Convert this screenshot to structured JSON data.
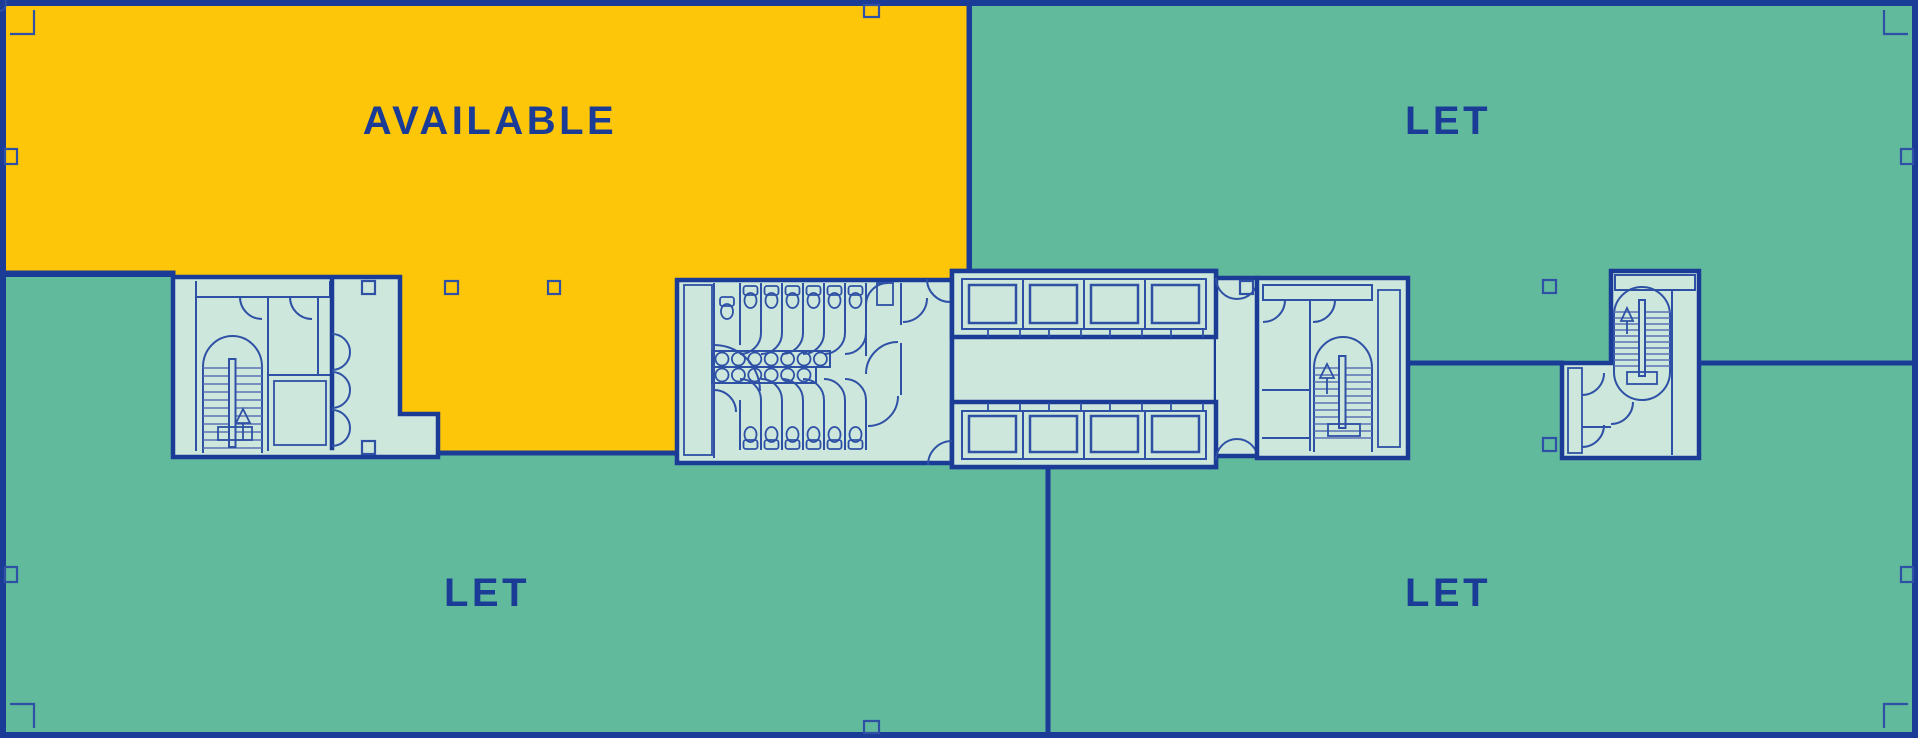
{
  "page": {
    "type": "interactive-letting-floorplan"
  },
  "units": [
    {
      "id": "available",
      "label": "AVAILABLE",
      "status": "available"
    },
    {
      "id": "let-top-right",
      "label": "LET",
      "status": "let"
    },
    {
      "id": "let-bottom-left",
      "label": "LET",
      "status": "let"
    },
    {
      "id": "let-bottom-right",
      "label": "LET",
      "status": "let"
    }
  ],
  "colors": {
    "available": "#FDC608",
    "let": "#62BA9D",
    "core": "#CEE7DC",
    "lift_car": "#97D1BB",
    "ink": "#1B3C96",
    "line": "#2E51A6",
    "tread": "#5872B4"
  }
}
